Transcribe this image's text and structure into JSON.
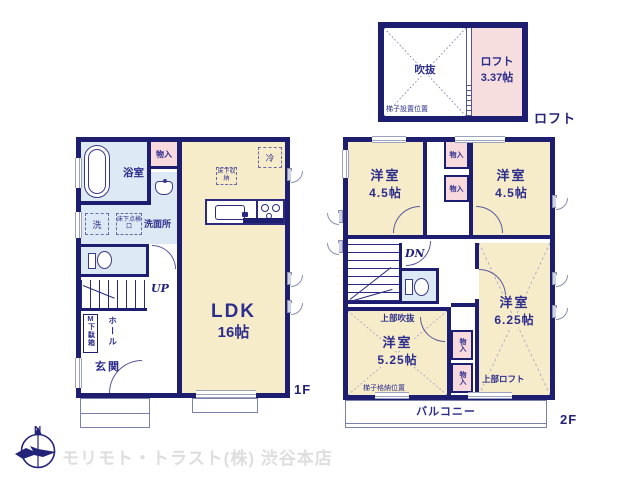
{
  "watermark": {
    "company": "モリモト・トラスト(株) 渋谷本店"
  },
  "compass": {
    "north": "N"
  },
  "loft_plan": {
    "tag": "ロフト",
    "void": "吹抜",
    "ladder_position": "梯子設置位置",
    "room": "ロフト",
    "size": "3.37帖"
  },
  "floor1": {
    "tag": "1F",
    "bath": "浴室",
    "closet": "物入",
    "laundry": "洗",
    "underfloor_hatch": "床下点検口",
    "washroom": "洗面所",
    "up": "UP",
    "shoe_mark": "M",
    "shoe_box": "下駄箱",
    "hall": "ホール",
    "entrance": "玄関",
    "ldk": "LDK",
    "ldk_size": "16帖",
    "fridge": "冷",
    "underfloor_storage": "床下収納"
  },
  "floor2": {
    "tag": "2F",
    "room_nw": {
      "name": "洋室",
      "size": "4.5帖"
    },
    "room_ne": {
      "name": "洋室",
      "size": "4.5帖"
    },
    "room_se": {
      "name": "洋室",
      "size": "6.25帖"
    },
    "room_sw": {
      "name": "洋室",
      "size": "5.25帖"
    },
    "closet": "物入",
    "down": "DN",
    "upper_void": "上部吹抜",
    "upper_loft": "上部ロフト",
    "ladder_storage": "梯子格納位置",
    "balcony": "バルコニー"
  },
  "colors": {
    "wall": "#1e1e70",
    "text": "#2d2d8c",
    "room_cream": "#f7ecca",
    "wet_blue": "#dde9f4",
    "closet_pink": "#f8d9de",
    "loft_pink": "#f6dede"
  }
}
